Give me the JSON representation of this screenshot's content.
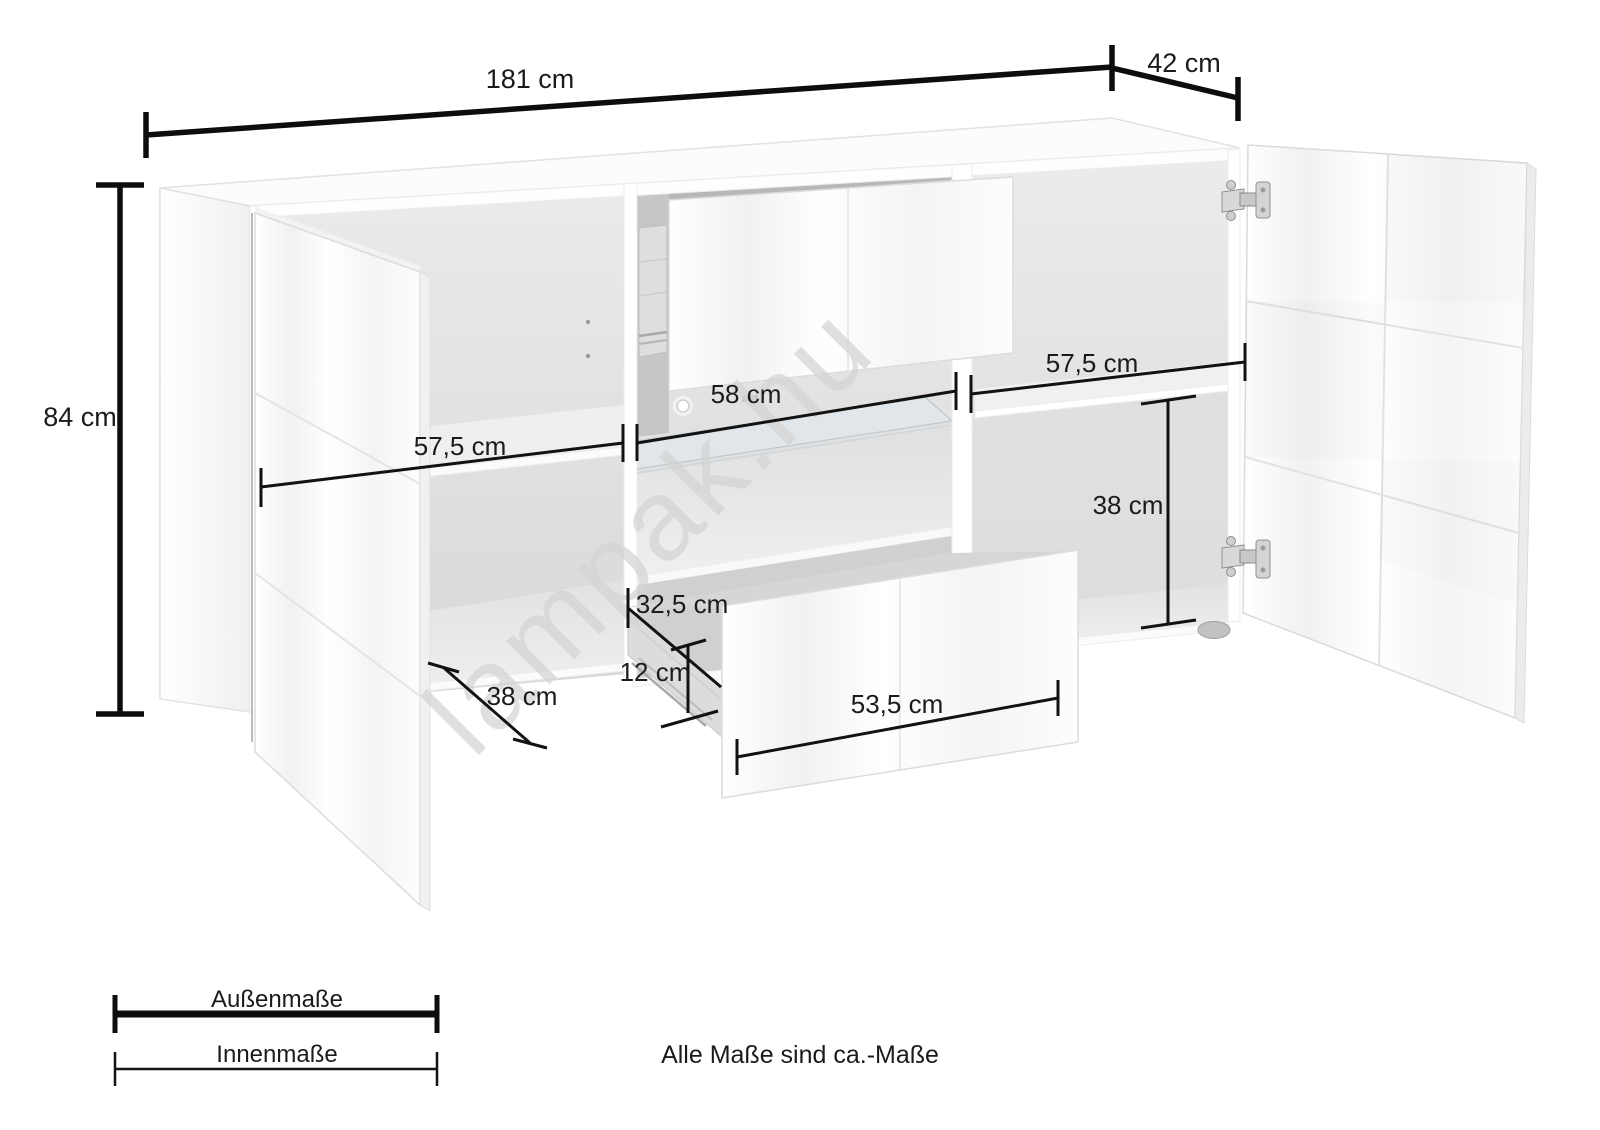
{
  "title": "Sideboard dimension diagram",
  "watermark": {
    "text": "lampak.hu"
  },
  "dimensions": {
    "outer": [
      {
        "name": "width",
        "label": "181 cm"
      },
      {
        "name": "depth",
        "label": "42 cm"
      },
      {
        "name": "height",
        "label": "84 cm"
      }
    ],
    "inner": [
      {
        "name": "left-compartment-width",
        "label": "57,5 cm"
      },
      {
        "name": "middle-shelf-width",
        "label": "58 cm"
      },
      {
        "name": "right-compartment-width",
        "label": "57,5 cm"
      },
      {
        "name": "right-compartment-height",
        "label": "38 cm"
      },
      {
        "name": "drawer-inner-depth",
        "label": "32,5 cm"
      },
      {
        "name": "drawer-inner-height",
        "label": "12 cm"
      },
      {
        "name": "left-compartment-depth",
        "label": "38 cm"
      },
      {
        "name": "drawer-front-width",
        "label": "53,5 cm"
      }
    ]
  },
  "legend": {
    "outer_label": "Außenmaße",
    "inner_label": "Innenmaße"
  },
  "note": {
    "text": "Alle Maße sind ca.-Maße"
  },
  "colors": {
    "dimension_line": "#0d0d0d",
    "label_text": "#1b1b1b",
    "watermark": "#d4d4d4",
    "furniture_edge": "#e2e2e2",
    "interior_shade": "#d9d9d9",
    "background": "#ffffff"
  }
}
